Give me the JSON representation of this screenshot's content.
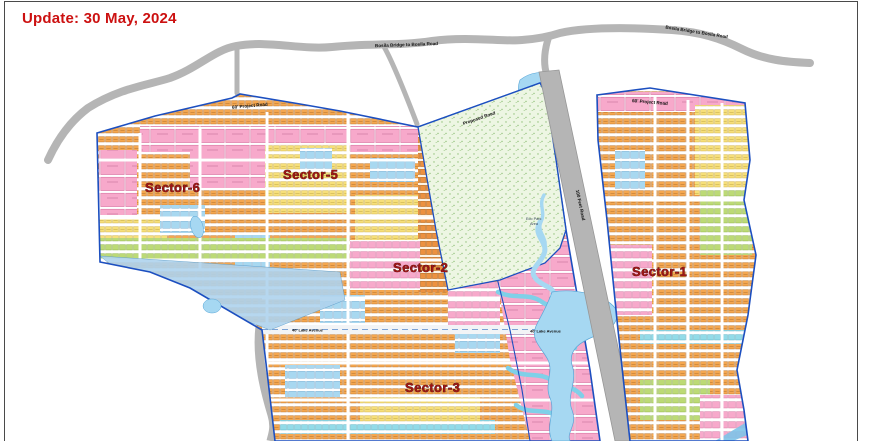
{
  "header": {
    "update_label": "Update: 30 May, 2024"
  },
  "map": {
    "sector_labels": {
      "s1": "Sector-1",
      "s2": "Sector-2",
      "s3": "Sector-3",
      "s5": "Sector-5",
      "s6": "Sector-6"
    },
    "road_labels": {
      "bridge_left": "Bosila Bridge to Bosila Road",
      "bridge_right": "Bosila Bridge to Bosila Road",
      "project_left": "60' Project Road",
      "project_right": "60' Project Road",
      "proposed": "Proposed Road",
      "diagonal": "100 Feet Road",
      "lake_avenue_left": "40' Lake Avenue",
      "lake_avenue_right": "40' Lake Avenue"
    },
    "green_area_label_line1": "Eco Park",
    "green_area_label_line2": "Area",
    "colors": {
      "boundary_blue": "#1c4fc0",
      "water": "#a6d8f2",
      "road_gray": "#b5b5b5",
      "plot_orange": "#f4a750",
      "plot_pink": "#f7a9cb",
      "plot_yellow": "#f6df7a",
      "plot_blue": "#a8d8f0",
      "plot_lime": "#bcda76",
      "sector_label_red": "#a01515",
      "update_red": "#cc1111"
    }
  }
}
